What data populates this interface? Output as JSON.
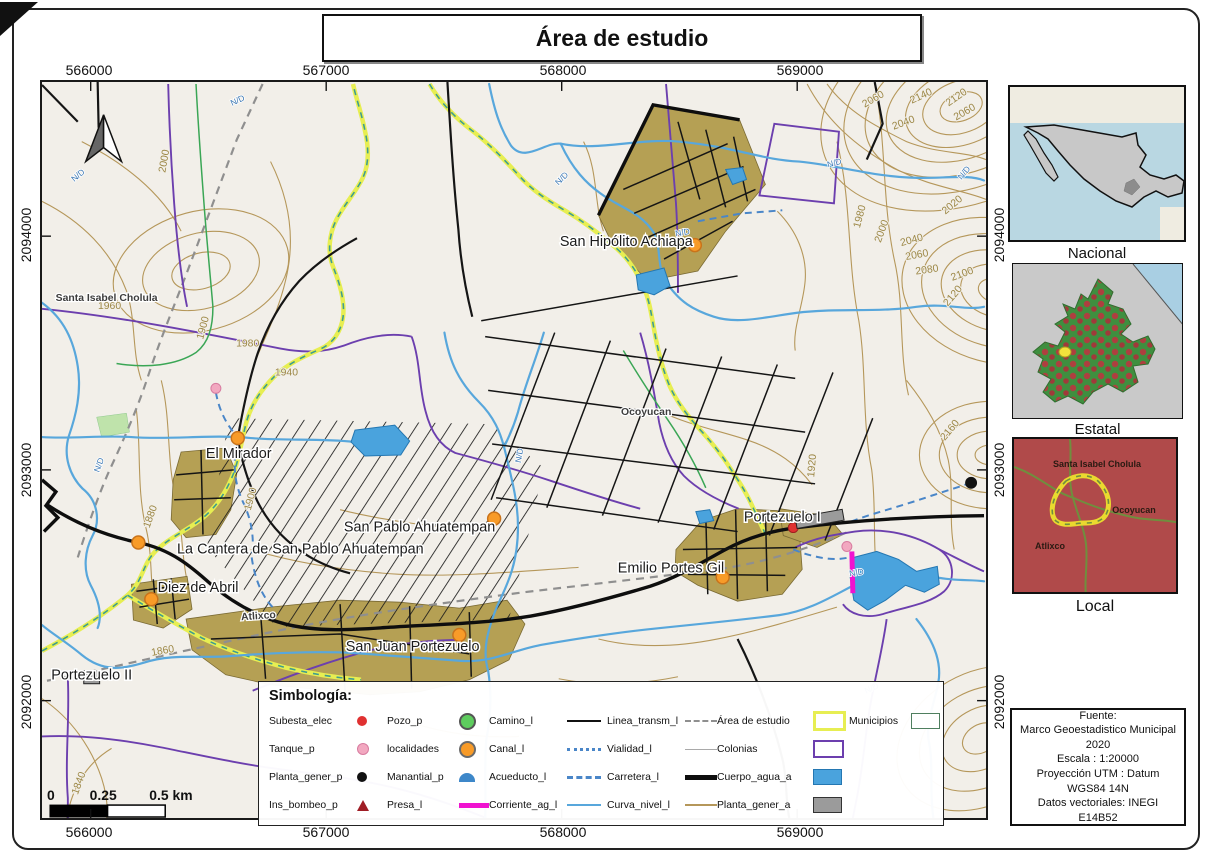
{
  "title": "Área de estudio",
  "axes": {
    "x": [
      "566000",
      "567000",
      "568000",
      "569000"
    ],
    "y": [
      "2094000",
      "2093000",
      "2092000"
    ]
  },
  "scalebar": {
    "start": "0",
    "mid": "0.25",
    "end": "0.5 km"
  },
  "map": {
    "stream_label": "N/D",
    "places": [
      {
        "name": "San Hipólito Achiapa"
      },
      {
        "name": "El Mirador"
      },
      {
        "name": "San Pablo Ahuatempan"
      },
      {
        "name": "La Cantera de San Pablo Ahuatempan"
      },
      {
        "name": "Diez de Abril"
      },
      {
        "name": "San Juan Portezuelo"
      },
      {
        "name": "Emilio Portes Gil"
      },
      {
        "name": "Portezuelo I"
      },
      {
        "name": "Portezuelo II"
      },
      {
        "name": "Santa Isabel Cholula"
      },
      {
        "name": "Ocoyucan"
      },
      {
        "name": "Atlixco"
      }
    ],
    "contours": [
      {
        "t": "2000"
      },
      {
        "t": "1960"
      },
      {
        "t": "1980"
      },
      {
        "t": "1940"
      },
      {
        "t": "1900"
      },
      {
        "t": "1900"
      },
      {
        "t": "1880"
      },
      {
        "t": "1860"
      },
      {
        "t": "1840"
      },
      {
        "t": "2060"
      },
      {
        "t": "2140"
      },
      {
        "t": "2120"
      },
      {
        "t": "2040"
      },
      {
        "t": "2060"
      },
      {
        "t": "1980"
      },
      {
        "t": "2000"
      },
      {
        "t": "2020"
      },
      {
        "t": "2040"
      },
      {
        "t": "2060"
      },
      {
        "t": "2080"
      },
      {
        "t": "2100"
      },
      {
        "t": "2120"
      },
      {
        "t": "2160"
      },
      {
        "t": "1920"
      }
    ]
  },
  "legend": {
    "title": "Simbología:",
    "items": [
      {
        "label": "Subesta_elec",
        "symbol": "dot-red"
      },
      {
        "label": "Pozo_p",
        "symbol": "circle-green"
      },
      {
        "label": "Camino_l",
        "symbol": "line-black"
      },
      {
        "label": "Linea_transm_l",
        "symbol": "line-gray-dashed"
      },
      {
        "label": "Área de estudio",
        "symbol": "rect-yellow"
      },
      {
        "label": "Municipios",
        "symbol": "rect-green-outline"
      },
      {
        "label": "Tanque_p",
        "symbol": "dot-pink"
      },
      {
        "label": "localidades",
        "symbol": "circle-orange"
      },
      {
        "label": "Canal_l",
        "symbol": "line-blue-dotted"
      },
      {
        "label": "Vialidad_l",
        "symbol": "line-gray-thin"
      },
      {
        "label": "Colonias",
        "symbol": "rect-purple"
      },
      {
        "label": "Planta_gener_p",
        "symbol": "dot-black"
      },
      {
        "label": "Manantial_p",
        "symbol": "semicircle-blue"
      },
      {
        "label": "Acueducto_l",
        "symbol": "line-blue-dashed"
      },
      {
        "label": "Carretera_l",
        "symbol": "line-black-thick"
      },
      {
        "label": "Cuerpo_agua_a",
        "symbol": "rect-blue-fill"
      },
      {
        "label": "Ins_bombeo_p",
        "symbol": "triangle-darkred"
      },
      {
        "label": "Presa_l",
        "symbol": "line-magenta-thick"
      },
      {
        "label": "Corriente_ag_l",
        "symbol": "line-blue"
      },
      {
        "label": "Curva_nivel_l",
        "symbol": "line-tan"
      },
      {
        "label": "Planta_gener_a",
        "symbol": "rect-gray-fill"
      }
    ]
  },
  "insets": {
    "nacional": {
      "caption": "Nacional"
    },
    "estatal": {
      "caption": "Estatal"
    },
    "local": {
      "caption": "Local",
      "labels": [
        "Santa Isabel Cholula",
        "Ocoyucan",
        "Atlixco"
      ]
    }
  },
  "source": {
    "lines": [
      "Fuente:",
      "Marco Geoestadistico Municipal",
      "2020",
      "Escala : 1:20000",
      "Proyección UTM : Datum",
      "WGS84 14N",
      "Datos vectoriales: INEGI",
      "E14B52"
    ]
  },
  "colors": {
    "map_bg": "#f2efe9",
    "contour": "#b5975a",
    "water": "#4aa3dd",
    "urban": "#b5a054",
    "colonias_purple": "#6c3fae",
    "municipio_yellow": "#e7ee52",
    "presa_magenta": "#f012d0",
    "locality_orange": "#f89b28",
    "substation_red": "#e03131",
    "transmission_gray": "#8f8f8f",
    "green_line": "#3aa655",
    "local_inset_bg": "#b04a4a"
  }
}
